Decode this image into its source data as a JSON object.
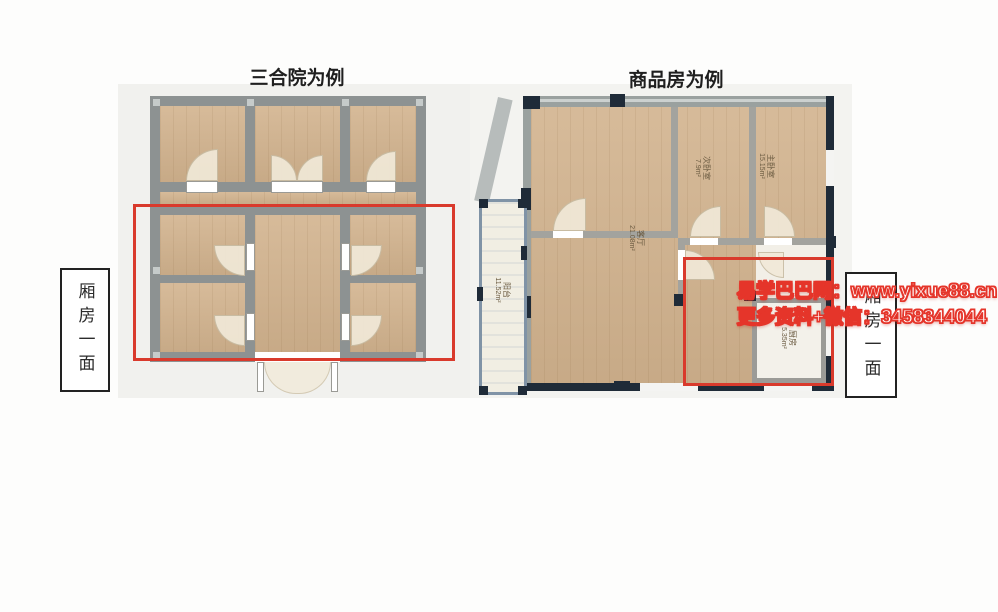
{
  "titles": {
    "left": "三合院为例",
    "right": "商品房为例"
  },
  "side_labels": {
    "left": "厢房一面",
    "right": "厢房一面"
  },
  "watermark": {
    "line1": "易学巴巴网：www.yixue88.cn",
    "line2": "更多资料+微信：3458344044"
  },
  "rooms": {
    "balcony": {
      "name": "阳台",
      "area": "11.52m²"
    },
    "living": {
      "name": "客厅",
      "area": "21.08m²"
    },
    "bedroom_small": {
      "name": "次卧室",
      "area": "7.9m²"
    },
    "bedroom_master": {
      "name": "主卧室",
      "area": "15.15m²"
    },
    "kitchen": {
      "name": "厨房",
      "area": "5.35m²"
    }
  },
  "colors": {
    "highlight_red": "#d93a2c",
    "watermark_red": "#e5352a",
    "wood_floor": "#d2b38e",
    "wall_gray": "#8d9292",
    "dark_wall": "#1f2b38",
    "balcony_blue": "#8093a6"
  }
}
